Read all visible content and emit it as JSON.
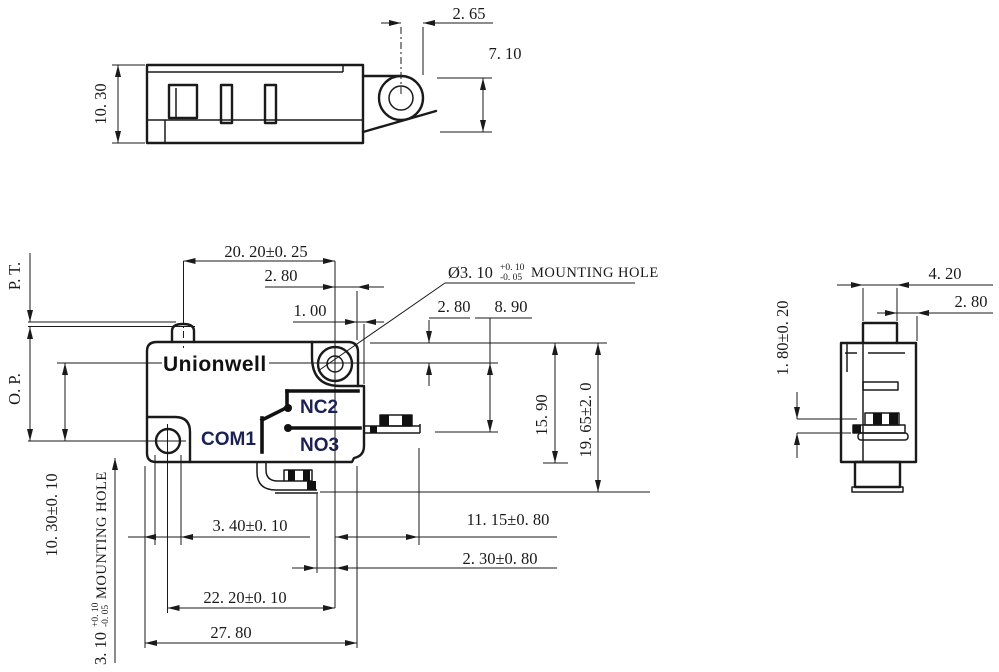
{
  "top_view": {
    "height": "10. 30",
    "hole_offset": "2. 65",
    "lug_height": "7. 10"
  },
  "front_view": {
    "brand": "Unionwell",
    "terminal_nc": "NC2",
    "terminal_com": "COM1",
    "terminal_no": "NO3",
    "pre_travel": "P. T.",
    "operating_position": "O. P.",
    "plunger_to_hole": "20. 20±0. 25",
    "hole_to_edge": "2. 80",
    "edge_step": "1. 00",
    "callout_dia": "Ø3. 10",
    "callout_tol_plus": "+0. 10",
    "callout_tol_minus": "-0. 05",
    "callout_label": "MOUNTING HOLE",
    "top_to_hole": "2. 80",
    "hole_to_no_terminal": "8. 90",
    "body_height": "15. 90",
    "overall_height": "19. 65±2. 0",
    "hole_spacing_vertical": "10. 30±0. 10",
    "hole_dia": "3. 10",
    "hole_dia_tol_plus": "+0. 10",
    "hole_dia_tol_minus": "-0. 05",
    "hole_dia_label": "MOUNTING HOLE",
    "com_to_hole": "3. 40±0. 10",
    "no_terminal_length": "11. 15±0. 80",
    "terminal_offset": "2. 30±0. 80",
    "hole_spacing_horizontal": "22. 20±0. 10",
    "overall_width": "27. 80"
  },
  "side_view": {
    "plunger_width": "4. 20",
    "plunger_to_edge": "2. 80",
    "terminal_height": "1. 80±0. 20"
  },
  "colors": {
    "line": "#1a1a1a",
    "terminal_text": "#1c2153"
  }
}
